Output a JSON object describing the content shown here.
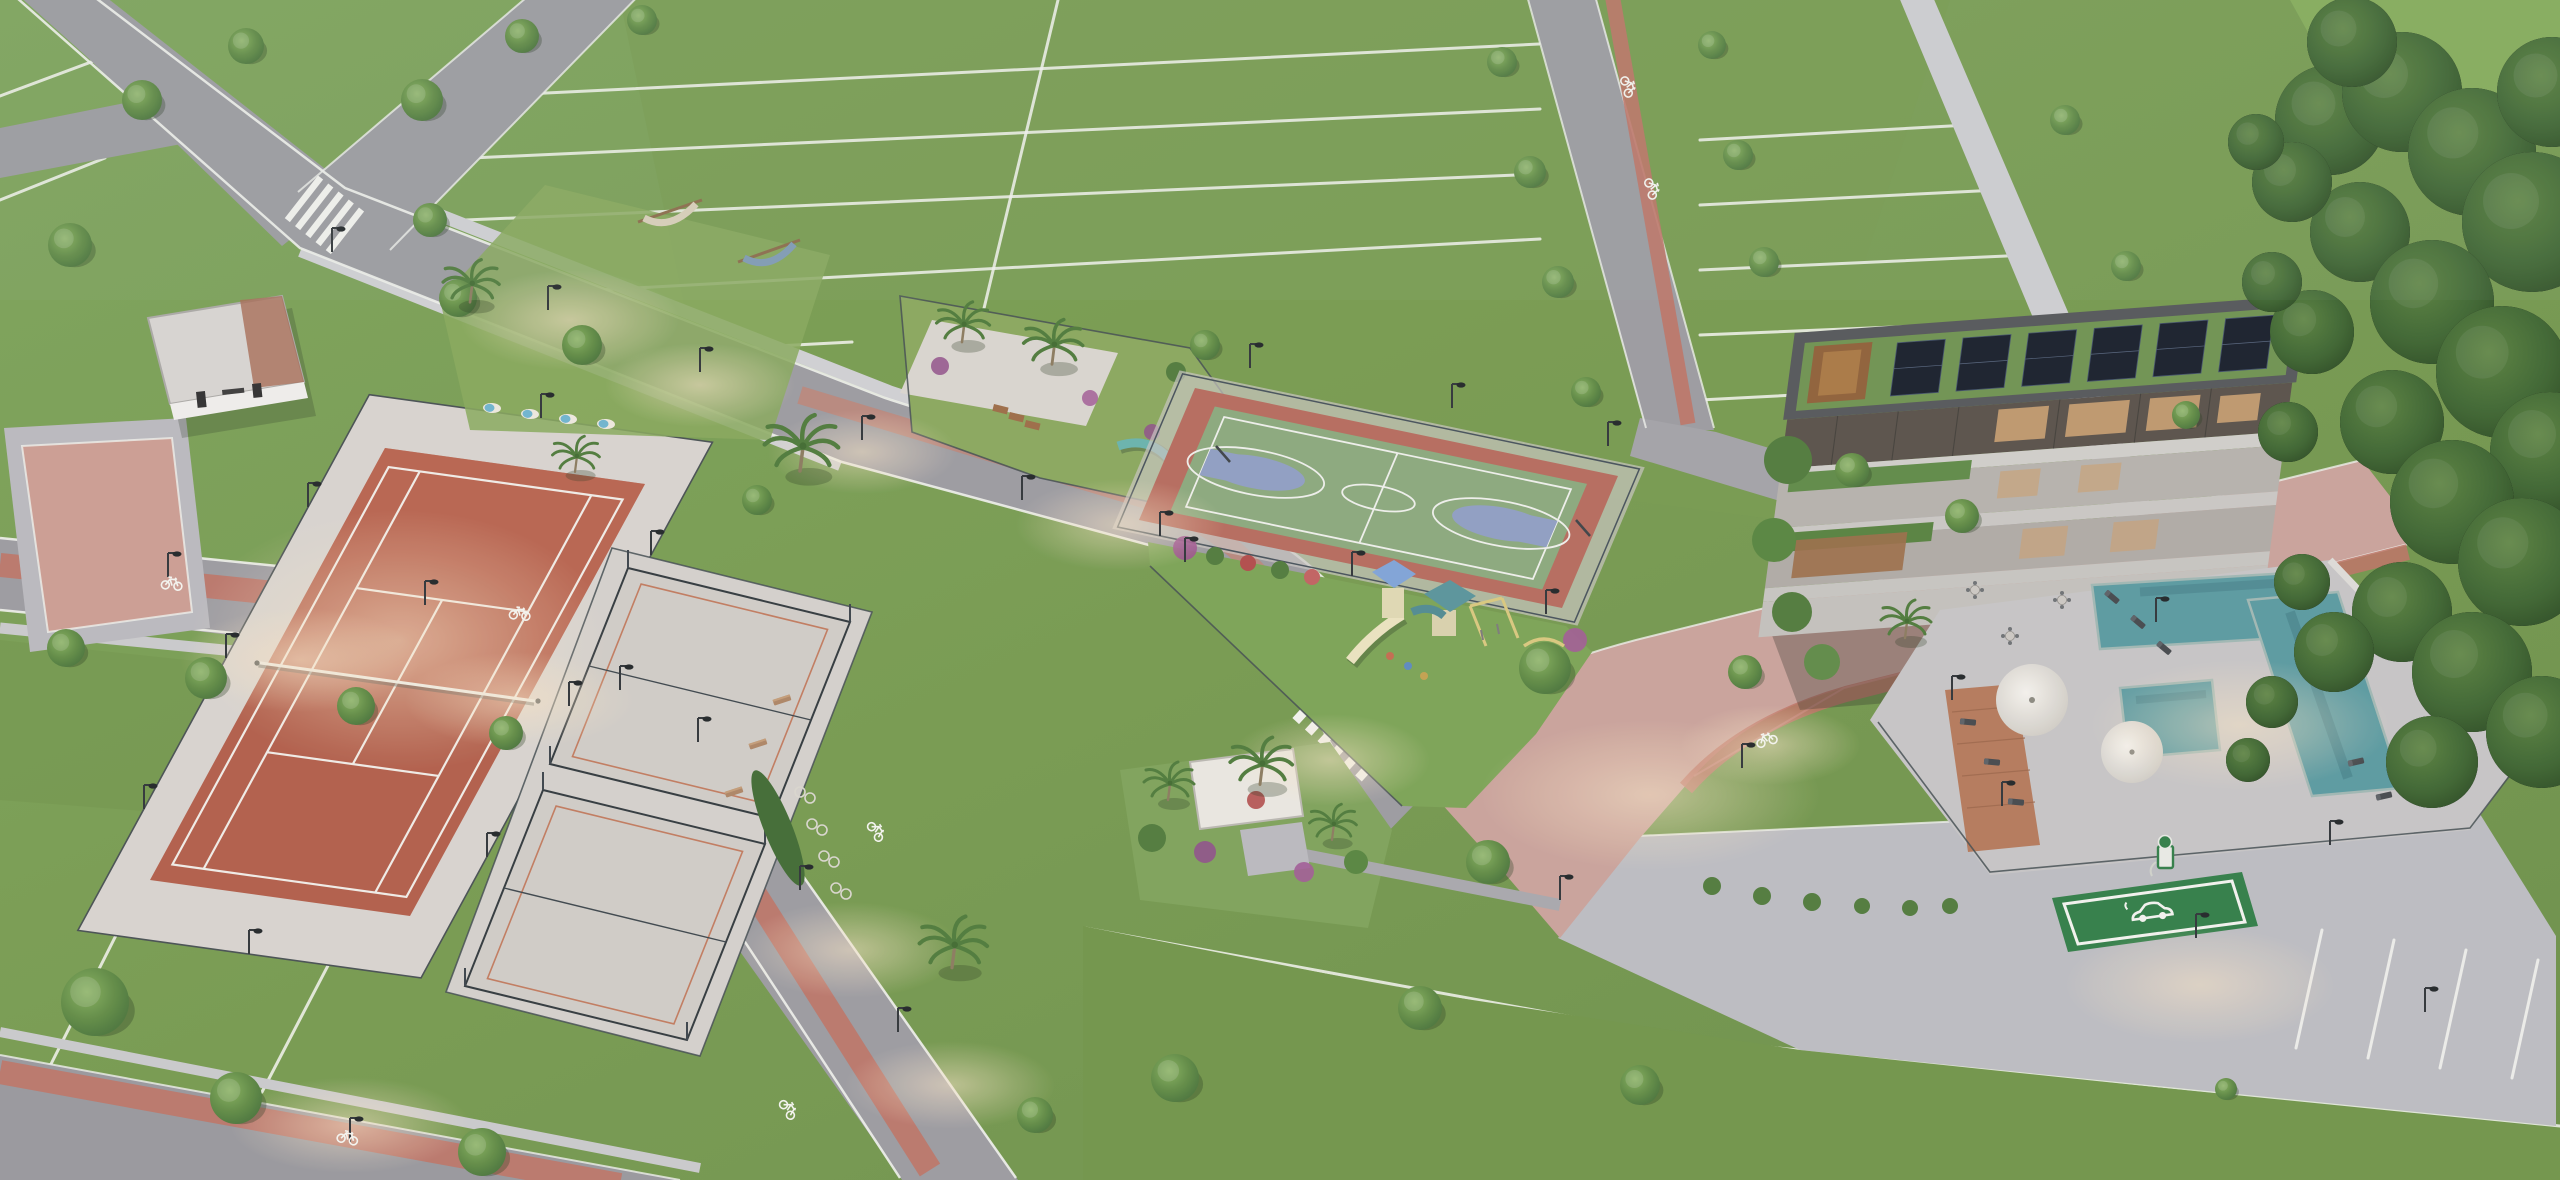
{
  "meta": {
    "title": "Aerial dusk rendering of a master-planned residential community amenities core",
    "media_type": "3d-architectural-rendering",
    "view": "aerial-oblique"
  },
  "areas": [
    {
      "id": "residential-lots",
      "label": "Subdivided residential lots separated by white lines"
    },
    {
      "id": "tennis-court",
      "label": "Clay tennis court with net and perimeter fence"
    },
    {
      "id": "padel-courts",
      "label": "Two fenced padel courts on concrete pad"
    },
    {
      "id": "basketball-court",
      "label": "Multi-sport basketball court with blue keys and red apron"
    },
    {
      "id": "playground",
      "label": "Children's playground with slides, swings and climbers"
    },
    {
      "id": "dog-park",
      "label": "Fenced pet park with agility equipment and palms"
    },
    {
      "id": "clubhouse",
      "label": "Three-story clubhouse with green roof and solar panels"
    },
    {
      "id": "swimming-pool",
      "label": "Resort pool deck with loungers and umbrellas"
    },
    {
      "id": "ev-charging-spot",
      "label": "Green EV charging parking space with charger kiosk"
    },
    {
      "id": "parking-area",
      "label": "Paved visitor parking with striped stalls"
    },
    {
      "id": "restroom-building",
      "label": "White amenity services building"
    },
    {
      "id": "hammock-garden",
      "label": "Hammock and sun-lounger garden"
    },
    {
      "id": "central-garden",
      "label": "Tropical pocket garden with white canopy"
    },
    {
      "id": "bike-lanes",
      "label": "Red cycle lanes with painted bicycle markings"
    },
    {
      "id": "forest",
      "label": "Preserved tree grove along the east edge"
    },
    {
      "id": "streets",
      "label": "Internal streets with crosswalks and street lamps"
    }
  ],
  "icons": [
    {
      "name": "bicycle-lane-marking",
      "glyph": "painted white bicycle"
    },
    {
      "name": "ev-car-icon",
      "glyph": "white electric car on green stall"
    }
  ],
  "colors": {
    "grass": "#79a053",
    "grass2": "#6e9449",
    "grass-light": "#8aab61",
    "grass-dark": "#5d8142",
    "forest": "#3c6531",
    "forest2": "#2e5226",
    "road": "#9a9aa1",
    "road2": "#8f9097",
    "paver": "#b8b9bf",
    "paver-pink": "#c99d95",
    "pink-road": "#c9a29b",
    "bike": "#bd7265",
    "curb": "#eef0ec",
    "walk": "#ccccd1",
    "clay": "#b05c49",
    "clay2": "#bd6954",
    "concrete": "#d6d2cf",
    "fence": "#414b51",
    "bbred": "#b56a5d",
    "bbgreen": "#8aa87d",
    "bbblue": "#8e9dc3",
    "pool": "#5899a1",
    "pool2": "#47858e",
    "deck": "#c6c5c7",
    "wood": "#b4795b",
    "roofdark": "#53565a",
    "groof": "#6d9251",
    "solar": "#161d2b",
    "bronze": "#8e5f38",
    "facade": "#b5b1ad",
    "glass": "#575049",
    "warm": "#c99f72",
    "ev": "#2f7d47",
    "white": "#f2f3f0",
    "canopy": "#e9e7e2",
    "tree1": "#6d9750",
    "tree2": "#4a7639",
    "palm": "#527e3e",
    "glow": "#f5e2c6"
  },
  "scatter": {
    "trees": [
      [
        70,
        245,
        22
      ],
      [
        142,
        100,
        20
      ],
      [
        246,
        46,
        18
      ],
      [
        422,
        100,
        21
      ],
      [
        522,
        36,
        17
      ],
      [
        642,
        20,
        15
      ],
      [
        458,
        298,
        19
      ],
      [
        582,
        345,
        20
      ],
      [
        757,
        500,
        15
      ],
      [
        66,
        648,
        19
      ],
      [
        206,
        678,
        21
      ],
      [
        356,
        706,
        19
      ],
      [
        506,
        733,
        17
      ],
      [
        95,
        1002,
        34
      ],
      [
        236,
        1098,
        26
      ],
      [
        482,
        1152,
        24
      ],
      [
        1035,
        1115,
        18
      ],
      [
        1175,
        1078,
        24
      ],
      [
        1420,
        1008,
        22
      ],
      [
        1640,
        1085,
        20
      ],
      [
        1545,
        668,
        26
      ],
      [
        1488,
        862,
        22
      ],
      [
        1502,
        62,
        15
      ],
      [
        1530,
        172,
        16
      ],
      [
        1558,
        282,
        16
      ],
      [
        1586,
        392,
        15
      ],
      [
        1712,
        45,
        14
      ],
      [
        1738,
        155,
        15
      ],
      [
        1764,
        262,
        15
      ],
      [
        1852,
        470,
        17
      ],
      [
        1962,
        516,
        17
      ],
      [
        2065,
        120,
        15
      ],
      [
        2126,
        266,
        15
      ],
      [
        2186,
        415,
        14
      ],
      [
        1745,
        672,
        17
      ],
      [
        430,
        220,
        17
      ],
      [
        1205,
        345,
        15
      ],
      [
        2226,
        1089,
        11
      ]
    ],
    "palms": [
      [
        470,
        300,
        38
      ],
      [
        800,
        468,
        50
      ],
      [
        575,
        470,
        32
      ],
      [
        962,
        340,
        36
      ],
      [
        1052,
        362,
        40
      ],
      [
        952,
        965,
        46
      ],
      [
        1168,
        798,
        34
      ],
      [
        1260,
        782,
        42
      ],
      [
        1332,
        838,
        32
      ],
      [
        1905,
        636,
        34
      ]
    ],
    "forest": [
      [
        2330,
        120,
        55
      ],
      [
        2402,
        92,
        60
      ],
      [
        2472,
        152,
        64
      ],
      [
        2532,
        222,
        70
      ],
      [
        2360,
        232,
        50
      ],
      [
        2432,
        302,
        62
      ],
      [
        2502,
        372,
        66
      ],
      [
        2550,
        452,
        60
      ],
      [
        2392,
        422,
        52
      ],
      [
        2452,
        502,
        62
      ],
      [
        2522,
        562,
        64
      ],
      [
        2402,
        612,
        50
      ],
      [
        2472,
        672,
        60
      ],
      [
        2542,
        732,
        56
      ],
      [
        2432,
        762,
        46
      ],
      [
        2352,
        42,
        45
      ],
      [
        2552,
        92,
        55
      ],
      [
        2292,
        182,
        40
      ],
      [
        2312,
        332,
        42
      ],
      [
        2334,
        652,
        40
      ],
      [
        2256,
        142,
        28
      ],
      [
        2272,
        282,
        30
      ],
      [
        2288,
        432,
        30
      ],
      [
        2302,
        582,
        28
      ],
      [
        2272,
        702,
        26
      ],
      [
        2248,
        760,
        22
      ]
    ],
    "lamps": [
      [
        332,
        252
      ],
      [
        548,
        310
      ],
      [
        700,
        372
      ],
      [
        862,
        440
      ],
      [
        1022,
        500
      ],
      [
        1185,
        562
      ],
      [
        168,
        577
      ],
      [
        425,
        605
      ],
      [
        620,
        690
      ],
      [
        698,
        742
      ],
      [
        800,
        890
      ],
      [
        898,
        1032
      ],
      [
        1560,
        900
      ],
      [
        1742,
        768
      ],
      [
        1952,
        700
      ],
      [
        2156,
        622
      ],
      [
        2002,
        806
      ],
      [
        2330,
        845
      ],
      [
        2196,
        938
      ],
      [
        2425,
        1012
      ],
      [
        350,
        1142
      ],
      [
        308,
        507
      ],
      [
        226,
        658
      ],
      [
        144,
        809
      ],
      [
        651,
        555
      ],
      [
        569,
        706
      ],
      [
        487,
        857
      ],
      [
        541,
        418
      ],
      [
        249,
        954
      ],
      [
        1250,
        368
      ],
      [
        1452,
        408
      ],
      [
        1608,
        446
      ],
      [
        1160,
        536
      ],
      [
        1352,
        576
      ],
      [
        1546,
        614
      ]
    ],
    "glows": [
      [
        700,
        385,
        95,
        42
      ],
      [
        862,
        452,
        95,
        42
      ],
      [
        1120,
        525,
        105,
        46
      ],
      [
        1330,
        760,
        100,
        46
      ],
      [
        300,
        660,
        120,
        52
      ],
      [
        520,
        700,
        115,
        48
      ],
      [
        400,
        640,
        210,
        130
      ],
      [
        850,
        950,
        110,
        48
      ],
      [
        1650,
        795,
        170,
        75
      ],
      [
        2240,
        725,
        150,
        65
      ],
      [
        2200,
        985,
        135,
        58
      ],
      [
        350,
        1125,
        120,
        48
      ],
      [
        950,
        1085,
        105,
        44
      ],
      [
        1770,
        745,
        90,
        40
      ],
      [
        570,
        320,
        110,
        50
      ]
    ],
    "bikes": [
      [
        172,
        582,
        6
      ],
      [
        520,
        612,
        6
      ],
      [
        790,
        1108,
        57
      ],
      [
        878,
        830,
        57
      ],
      [
        1766,
        738,
        -17
      ],
      [
        1630,
        86,
        74
      ],
      [
        1654,
        188,
        74
      ],
      [
        348,
        1136,
        12
      ]
    ],
    "lot_lines": [
      [
        506,
        95,
        1539,
        44
      ],
      [
        428,
        160,
        1540,
        109
      ],
      [
        350,
        225,
        1540,
        174
      ],
      [
        560,
        292,
        1540,
        239
      ],
      [
        700,
        350,
        852,
        342
      ],
      [
        1058,
        0,
        950,
        450
      ],
      [
        1700,
        140,
        1968,
        125
      ],
      [
        1700,
        205,
        1998,
        190
      ],
      [
        1700,
        270,
        2028,
        255
      ],
      [
        1700,
        335,
        2040,
        321
      ],
      [
        1700,
        400,
        2040,
        382
      ],
      [
        0,
        96,
        150,
        40
      ],
      [
        0,
        200,
        105,
        158
      ],
      [
        150,
        868,
        48,
        1070
      ],
      [
        370,
        885,
        262,
        1092
      ],
      [
        1085,
        928,
        1698,
        1040
      ],
      [
        1698,
        1040,
        2560,
        1126
      ],
      [
        1310,
        998,
        2560,
        1155
      ],
      [
        1085,
        930,
        1102,
        1180
      ]
    ],
    "park_lines": [
      [
        2322,
        930,
        2296,
        1048
      ],
      [
        2394,
        940,
        2368,
        1058
      ],
      [
        2466,
        950,
        2440,
        1068
      ],
      [
        2538,
        960,
        2512,
        1078
      ]
    ],
    "benches": [
      [
        782,
        700,
        -18
      ],
      [
        758,
        744,
        -18
      ],
      [
        734,
        792,
        -18
      ]
    ],
    "blue_loungers": [
      [
        492,
        408,
        4
      ],
      [
        530,
        414,
        4
      ],
      [
        568,
        419,
        4
      ],
      [
        606,
        424,
        4
      ]
    ],
    "pool_loungers": [
      [
        2412,
        626,
        -13
      ],
      [
        2440,
        660,
        -13
      ],
      [
        2468,
        696,
        -13
      ],
      [
        2356,
        762,
        -13
      ],
      [
        2384,
        796,
        -13
      ],
      [
        2112,
        597,
        40
      ],
      [
        2138,
        622,
        40
      ],
      [
        2164,
        648,
        40
      ],
      [
        1968,
        722,
        5
      ],
      [
        1992,
        762,
        5
      ],
      [
        2016,
        802,
        5
      ]
    ],
    "tables": [
      [
        1975,
        590
      ],
      [
        2010,
        636
      ],
      [
        2062,
        600
      ]
    ],
    "hedge_dots": [
      [
        1712,
        886,
        9
      ],
      [
        1762,
        896,
        9
      ],
      [
        1812,
        902,
        9
      ],
      [
        1862,
        906,
        8
      ],
      [
        1910,
        908,
        8
      ],
      [
        1950,
        906,
        8
      ]
    ]
  }
}
